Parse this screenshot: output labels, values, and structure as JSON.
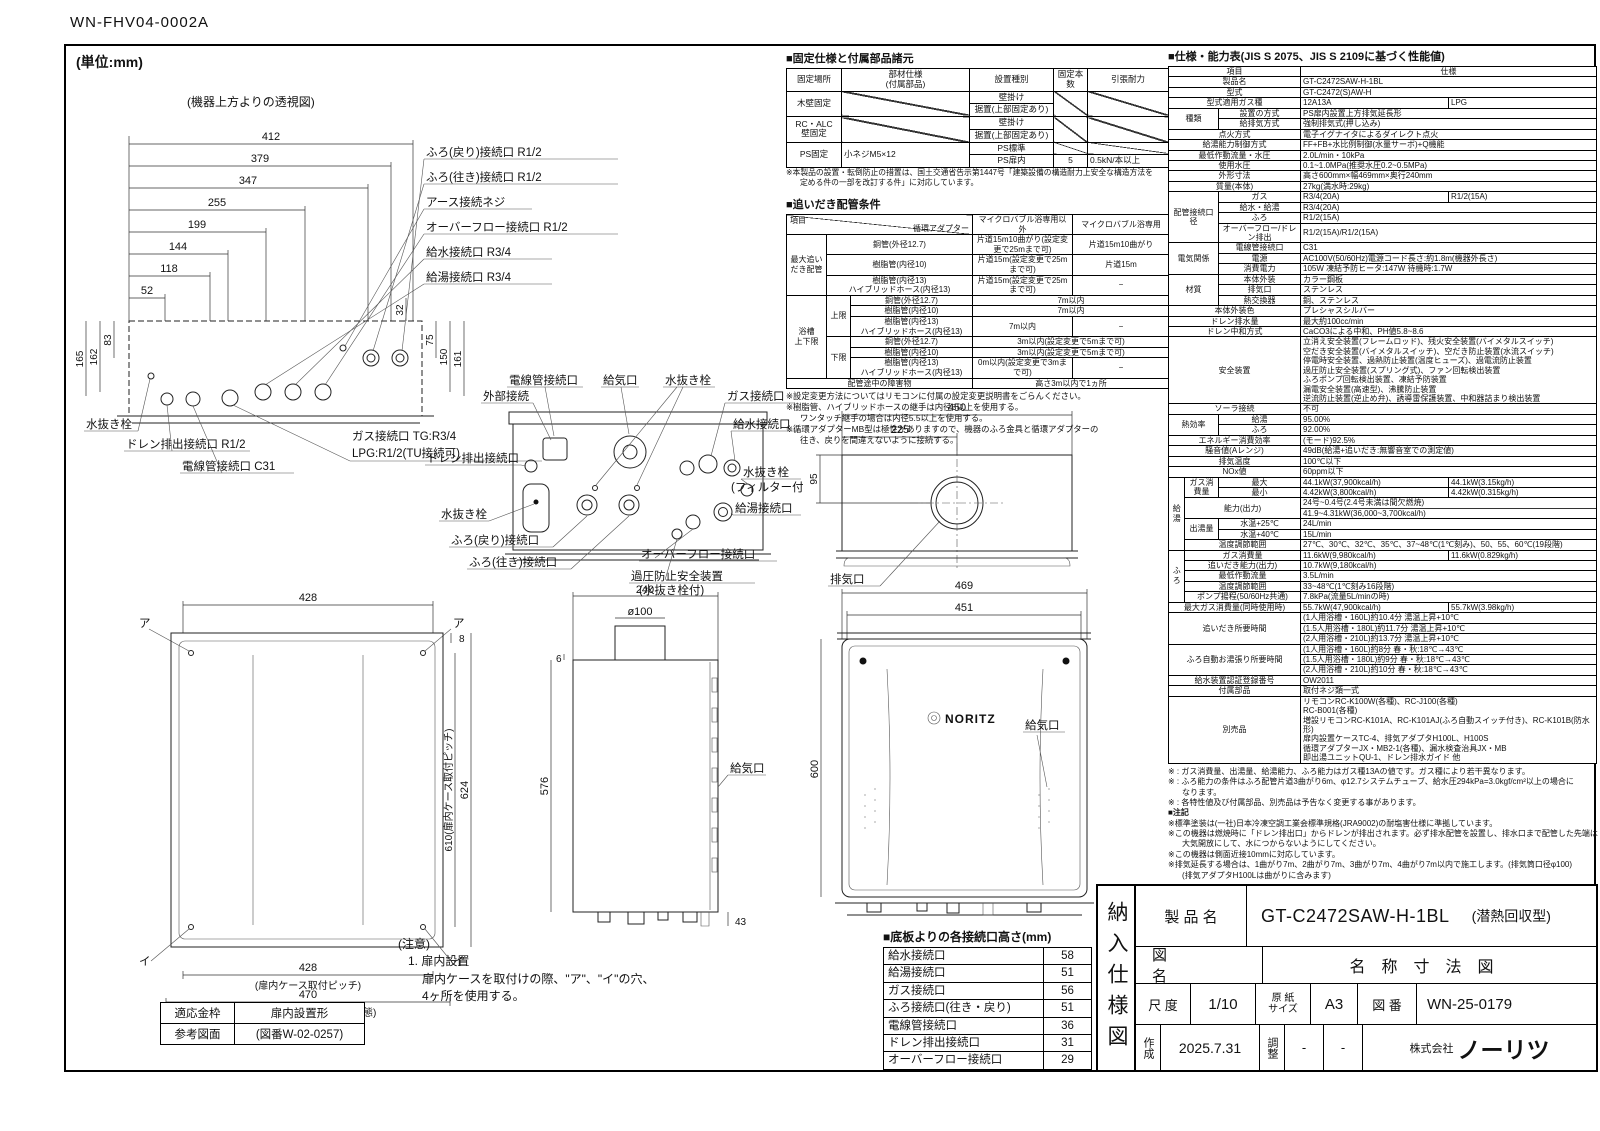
{
  "doc": {
    "number": "WN-FHV04-0002A",
    "unit": "(単位:mm)"
  },
  "top_view": {
    "caption": "(機器上方よりの透視図)",
    "d412": "412",
    "d379": "379",
    "d347": "347",
    "d255": "255",
    "d199": "199",
    "d144": "144",
    "d118": "118",
    "d52": "52",
    "d32": "32",
    "d165": "165",
    "d162": "162",
    "d83": "83",
    "d75": "75",
    "d150": "150",
    "d161": "161",
    "lbl_furo_return": "ふろ(戻り)接続口 R1/2",
    "lbl_furo_going": "ふろ(往き)接続口 R1/2",
    "lbl_earth": "アース接続ネジ",
    "lbl_overflow": "オーバーフロー接続口 R1/2",
    "lbl_water": "給水接続口 R3/4",
    "lbl_hot": "給湯接続口 R3/4",
    "lbl_drain_plug": "水抜き栓",
    "lbl_gas1": "ガス接続口 TG:R3/4",
    "lbl_gas2": "LPG:R1/2(TU接続可)",
    "lbl_drain": "ドレン排出接続口 R1/2",
    "lbl_conduit": "電線管接続口 C31"
  },
  "rear_view": {
    "lbl_conduit": "電線管接続口",
    "lbl_external": "外部接続",
    "lbl_air": "給気口",
    "lbl_plug_top": "水抜き栓",
    "lbl_gas": "ガス接続口",
    "lbl_water": "給水接続口",
    "lbl_plug_filter1": "水抜き栓",
    "lbl_plug_filter2": "(フィルター付)",
    "lbl_hot": "給湯接続口",
    "lbl_drain": "ドレン排出接続口",
    "lbl_plug_left": "水抜き栓",
    "lbl_furo_return": "ふろ(戻り)接続口",
    "lbl_furo_going": "ふろ(往き)接続口",
    "lbl_overflow": "オーバーフロー接続口",
    "lbl_relief1": "過圧防止安全装置",
    "lbl_relief2": "(水抜き栓付)"
  },
  "top_rear_view": {
    "d450": "450",
    "d225": "225",
    "d95": "95",
    "lbl_exhaust": "排気口"
  },
  "front_left": {
    "d428_top": "428",
    "mark_a": "ア",
    "mark_i": "イ",
    "d8": "8",
    "d610": "610(扉内ケース取付ピッチ)",
    "d624": "624",
    "d428_bottom": "428",
    "cap428": "(扉内ケース取付ピッチ)",
    "d470": "470",
    "cap470": "(フロントカバーを外した状態)"
  },
  "side_view": {
    "d240": "240",
    "d100": "ø100",
    "d6": "6",
    "d576": "576",
    "lbl_air": "給気口",
    "d43": "43"
  },
  "front_right": {
    "d469": "469",
    "d451": "451",
    "d600": "600",
    "logo": "NORITZ",
    "lbl_air": "給気口"
  },
  "caution": {
    "title": "(注意)",
    "l1": "1. 扉内設置",
    "l2": "扉内ケースを取付けの際、\"ア\"、\"イ\"の穴、",
    "l3": "4ヶ所を使用する。"
  },
  "kanawaku": {
    "r1l": "適応金枠",
    "r1v": "扉内設置形",
    "r2l": "参考図面",
    "r2v": "(図番W-02-0257)"
  },
  "fixed_table": {
    "title": "■固定仕様と付属部品諸元",
    "h0": "固定場所",
    "h1a": "部材仕様",
    "h1b": "(付属部品)",
    "h2": "設置種別",
    "h3": "固定本数",
    "h4": "引張耐力",
    "wood": "木壁固定",
    "rc1": "RC・ALC",
    "rc2": "壁固定",
    "ps": "PS固定",
    "ps_part": "小ネジM5×12",
    "wall": "壁掛け",
    "floor": "据置(上部固定あり)",
    "ps_std": "PS標準",
    "ps_door": "PS扉内",
    "count": "5",
    "pull": "0.5kN/本以上",
    "note1": "※本製品の設置・転倒防止の措置は、国土交通省告示第1447号「建築設備の構造耐力上安全な構造方法を",
    "note2": "定める件の一部を改訂する件」に対応しています。"
  },
  "oidaki": {
    "title": "■追いだき配管条件",
    "header_item": "項目",
    "header_adapter": "循環アダプター",
    "col1": "マイクロバブル浴専用以外",
    "col2": "マイクロバブル浴専用",
    "group_max1": "最大追い",
    "group_max2": "だき配管",
    "group_bath1": "浴槽",
    "group_bath2": "上下限",
    "upper": "上限",
    "lower": "下限",
    "pipe_cu": "銅管(外径12.7)",
    "pipe_r10": "樹脂管(内径10)",
    "pipe_r13a": "樹脂管(内径13)",
    "pipe_r13b": "ハイブリッドホース(内径13)",
    "max_cu_1": "片道15m10曲がり(設定変更で25mまで可)",
    "max_cu_2": "片道15m10曲がり",
    "max_r10_1": "片道15m(設定変更で25mまで可)",
    "max_r10_2": "片道15m",
    "max_r13_1": "片道15m(設定変更で25mまで可)",
    "dash": "−",
    "up_cu": "7m以内",
    "up_r10": "7m以内",
    "up_r13": "7m以内",
    "low_cu": "3m以内(設定変更で5mまで可)",
    "low_r10": "3m以内(設定変更で5mまで可)",
    "low_r13": "0m以内(設定変更で3mまで可)",
    "obstacle_label": "配管途中の障害物",
    "obstacle_value": "高さ3m以内で1ヵ所",
    "n1": "※設定変更方法についてはリモコンに付属の設定変更説明書をごらんください。",
    "n2a": "※樹脂管、ハイブリッドホースの継手は内径8以上を使用する。",
    "n2b": "ワンタッチ継手の場合は内径5.5以上を使用する。",
    "n3a": "※循環アダプターMB型は極性がありますので、機器のふろ金具と循環アダプターの",
    "n3b": "往き、戻りを間違えないように接続する。"
  },
  "spec": {
    "title": "■仕様・能力表(JIS S 2075、JIS S 2109に基づく性能値)",
    "h_item": "項目",
    "h_spec": "仕様",
    "rows": [
      {
        "label": "製品名",
        "v": "GT-C2472SAW-H-1BL"
      },
      {
        "label": "型式",
        "v": "GT-C2472(S)AW-H"
      },
      {
        "label": "型式適用ガス種",
        "v": "12A13A",
        "v2": "LPG"
      },
      {
        "g": "種類",
        "label": "設置の方式",
        "v": "PS扉内設置上方排気延長形"
      },
      {
        "label": "給排気方式",
        "v": "強制排気式(押し込み)"
      },
      {
        "label": "点火方式",
        "v": "電子イグナイタによるダイレクト点火"
      },
      {
        "label": "給湯能力制御方式",
        "v": "FF+FB+水比例制御(水量サーボ)+Q機能"
      },
      {
        "label": "最低作動流量・水圧",
        "v": "2.0L/min・10kPa"
      },
      {
        "label": "使用水圧",
        "v": "0.1~1.0MPa(推奨水圧0.2~0.5MPa)"
      },
      {
        "label": "外形寸法",
        "v": "高さ600mm×幅469mm×奥行240mm"
      },
      {
        "label": "質量(本体)",
        "v": "27kg(満水時:29kg)"
      },
      {
        "g": "配管接続口径",
        "label": "ガス",
        "v": "R3/4(20A)",
        "v2": "R1/2(15A)"
      },
      {
        "label": "給水・給湯",
        "v": "R3/4(20A)"
      },
      {
        "label": "ふろ",
        "v": "R1/2(15A)"
      },
      {
        "label": "オーバーフロー/ドレン排出",
        "v": "R1/2(15A)/R1/2(15A)"
      },
      {
        "g": "電気関係",
        "label": "電線管接続口",
        "v": "C31"
      },
      {
        "label": "電源",
        "v": "AC100V(50/60Hz)電源コード長さ:約1.8m(機器外長さ)"
      },
      {
        "label": "消費電力",
        "v": "105W 凍結予防ヒータ:147W 待機時:1.7W"
      },
      {
        "g": "材質",
        "label": "本体外装",
        "v": "カラー鋼板"
      },
      {
        "label": "排気口",
        "v": "ステンレス"
      },
      {
        "label": "熱交換器",
        "v": "銅、ステンレス"
      },
      {
        "label": "本体外装色",
        "v": "プレシャスシルバー"
      },
      {
        "label": "ドレン排水量",
        "v": "最大約100cc/min"
      },
      {
        "label": "ドレン中和方式",
        "v": "CaCO3による中和、PH値5.8~8.6"
      },
      {
        "label": "安全装置",
        "lines": [
          "立消え安全装置(フレームロッド)、残火安全装置(バイメタルスイッチ)",
          "空だき安全装置(バイメタルスイッチ)、空だき防止装置(水流スイッチ)",
          "停電時安全装置、過熱防止装置(温度ヒューズ)、過電流防止装置",
          "過圧防止安全装置(スプリング式)、ファン回転検出装置",
          "ふろポンプ回転検出装置、凍結予防装置",
          "漏電安全装置(高速型)、沸騰防止装置",
          "逆流防止装置(逆止め弁)、誘導雷保護装置、中和器詰まり検出装置"
        ]
      },
      {
        "label": "ソーラ接続",
        "v": "不可"
      },
      {
        "g": "熱効率",
        "label": "給湯",
        "v": "95.00%"
      },
      {
        "label": "ふろ",
        "v": "92.00%"
      },
      {
        "label": "エネルギー消費効率",
        "v": "(モード)92.5%"
      },
      {
        "label": "騒音値(Aレンジ)",
        "v": "49dB(給湯+追いだき:無響音室での測定値)"
      },
      {
        "label": "排気温度",
        "v": "100℃以下"
      },
      {
        "label": "NOx値",
        "v": "60ppm以下"
      },
      {
        "g": "給湯",
        "g2": "ガス消費量",
        "label": "最大",
        "v": "44.1kW(37,900kcal/h)",
        "v2": "44.1kW(3.15kg/h)"
      },
      {
        "label": "最小",
        "v": "4.42kW(3,800kcal/h)",
        "v2": "4.42kW(0.315kg/h)"
      },
      {
        "label": "能力(出力)",
        "lines": [
          "24号~0.4号(2.4号未満は間欠燃焼)",
          "41.9~4.31kW(36,000~3,700kcal/h)"
        ]
      },
      {
        "g2": "出湯量",
        "label": "水温+25℃",
        "v": "24L/min"
      },
      {
        "label": "水温+40℃",
        "v": "15L/min"
      },
      {
        "label": "温度調節範囲",
        "v": "27℃、30℃、32℃、35℃、37~48℃(1℃刻み)、50、55、60℃(19段階)"
      },
      {
        "g": "ふろ",
        "label": "ガス消費量",
        "v": "11.6kW(9,980kcal/h)",
        "v2": "11.6kW(0.829kg/h)"
      },
      {
        "label": "追いだき能力(出力)",
        "v": "10.7kW(9,180kcal/h)"
      },
      {
        "label": "最低作動流量",
        "v": "3.5L/min"
      },
      {
        "label": "温度調節範囲",
        "v": "33~48℃(1℃刻み16段階)"
      },
      {
        "label": "ポンプ揚程(50/60Hz共通)",
        "v": "7.8kPa(流量5L/minの時)"
      },
      {
        "label": "最大ガス消費量(同時使用時)",
        "v": "55.7kW(47,900kcal/h)",
        "v2": "55.7kW(3.98kg/h)"
      },
      {
        "label": "追いだき所要時間",
        "lines": [
          "(1人用浴槽・160L)約10.4分 湯温上昇+10℃",
          "(1.5人用浴槽・180L)約11.7分 湯温上昇+10℃",
          "(2人用浴槽・210L)約13.7分 湯温上昇+10℃"
        ]
      },
      {
        "label": "ふろ自動お湯張り所要時間",
        "lines": [
          "(1人用浴槽・160L)約8分 春・秋:18℃→43℃",
          "(1.5人用浴槽・180L)約9分 春・秋:18℃→43℃",
          "(2人用浴槽・210L)約10分 春・秋:18℃→43℃"
        ]
      },
      {
        "label": "給水装置認証登録番号",
        "v": "OW2011"
      },
      {
        "label": "付属部品",
        "v": "取付ネジ類一式"
      },
      {
        "label": "別売品",
        "lines": [
          "リモコンRC-K100W(各種)、RC-J100(各種)",
          "RC-B001(各種)",
          "増設リモコンRC-K101A、RC-K101AJ(ふろ自動スイッチ付き)、RC-K101B(防水形)",
          "扉内設置ケースTC-4、排気アダプタH100L、H100S",
          "循環アダプターJX・MB2-1(各種)、漏水検査治具JX・MB",
          "即出湯ユニットQU-1、ドレン排水ガイド 他"
        ]
      }
    ]
  },
  "spec_notes": {
    "n1": "※ : ガス消費量、出湯量、給湯能力、ふろ能力はガス種13Aの値です。ガス種により若干異なります。",
    "n2a": "※ : ふろ能力の条件はふろ配管片道3曲がり6m、φ12.7システムチューブ、給水圧294kPa=3.0kgf/cm²以上の場合に",
    "n2b": "なります。",
    "n3": "※ : 各特性値及び付属部品、別売品は予告なく変更する事があります。",
    "note_title": "■注記",
    "n4": "※標準塗装は(一社)日本冷凍空調工業会標準規格(JRA9002)の耐塩害仕様に準拠しています。",
    "n5a": "※この機器は燃焼時に「ドレン排出口」からドレンが排出されます。必ず排水配管を設置し、排水口まで配管した先端は",
    "n5b": "大気開放にして、水につからないようにしてください。",
    "n6": "※この機器は側面近接10mmに対応しています。",
    "n7a": "※排気延長する場合は、1曲がり7m、2曲がり7m、3曲がり7m、4曲がり7m以内で施工します。(排気筒口径φ100)",
    "n7b": "(排気アダプタH100Lは曲がりに含みます)"
  },
  "heights": {
    "title": "■底板よりの各接続口高さ(mm)",
    "rows": [
      {
        "label": "給水接続口",
        "value": "58"
      },
      {
        "label": "給湯接続口",
        "value": "51"
      },
      {
        "label": "ガス接続口",
        "value": "56"
      },
      {
        "label": "ふろ接続口(往き・戻り)",
        "value": "51"
      },
      {
        "label": "電線管接続口",
        "value": "36"
      },
      {
        "label": "ドレン排出接続口",
        "value": "31"
      },
      {
        "label": "オーバーフロー接続口",
        "value": "29"
      }
    ]
  },
  "title_block": {
    "doc_type": "納入仕様図",
    "product_label": "製 品 名",
    "product_value": "GT-C2472SAW-H-1BL",
    "product_note": "(潜熱回収型)",
    "drawing_label": "図名",
    "drawing_value": "名称寸法図",
    "scale_label": "尺 度",
    "scale_value": "1/10",
    "paper_label1": "原 紙",
    "paper_label2": "サイズ",
    "paper_value": "A3",
    "no_label": "図 番",
    "no_value": "WN-25-0179",
    "created_label": "作成",
    "created_value": "2025.7.31",
    "adjust_label": "調整",
    "adjust_value1": "-",
    "adjust_value2": "-",
    "company_prefix": "株式会社",
    "company_name": "ノーリツ"
  }
}
